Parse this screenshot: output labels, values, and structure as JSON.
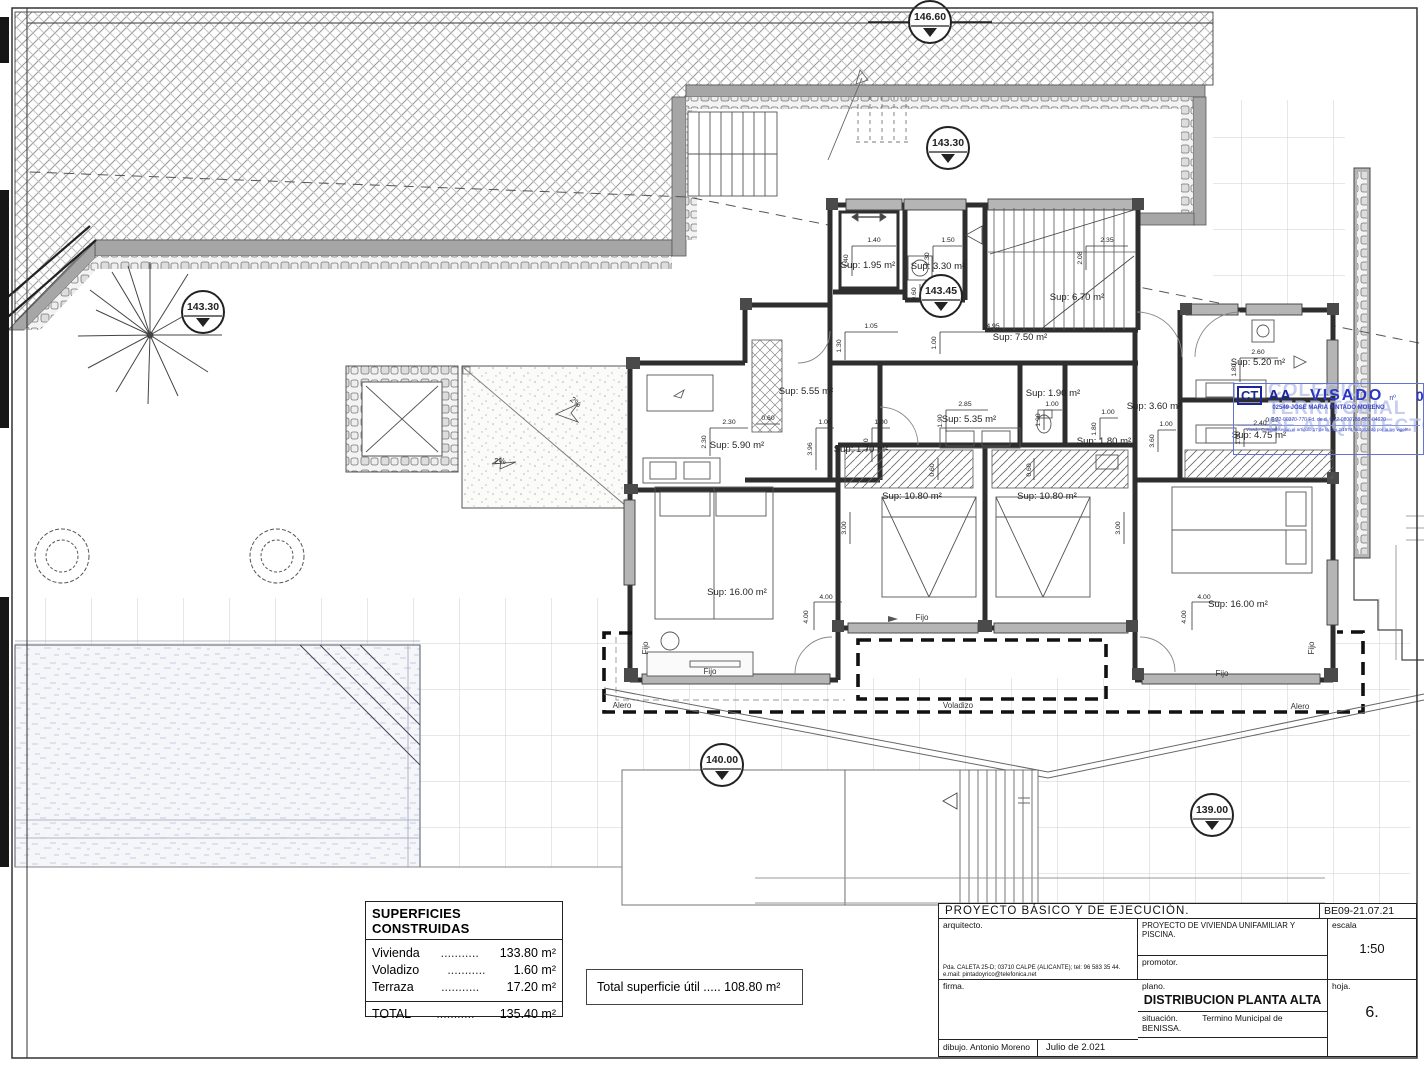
{
  "elevations": [
    "146.60",
    "143.30",
    "143.45",
    "143.30",
    "140.00",
    "139.00"
  ],
  "rooms": [
    "Sup: 1.95 m²",
    "Sup: 3.30 m²",
    "Sup: 6.70 m²",
    "Sup: 7.50 m²",
    "Sup: 5.55 m²",
    "Sup: 5.90 m²",
    "Sup: 1.70 m²",
    "Sup: 5.35 m²",
    "Sup: 1.90 m²",
    "Sup: 1.80 m²",
    "Sup: 3.60 m²",
    "Sup: 5.20 m²",
    "Sup: 4.75 m²",
    "Sup: 10.80 m²",
    "Sup: 10.80 m²",
    "Sup: 16.00 m²",
    "Sup: 16.00 m²"
  ],
  "dims": [
    "1.40",
    "1.40",
    "1.50",
    "2.30",
    "2.35",
    "2.08",
    "1.05",
    "1.30",
    "4.95",
    "1.00",
    "2.30",
    "2.30",
    "0.60",
    "1.00",
    "3.96",
    "1.00",
    "1.70",
    "2.85",
    "1.90",
    "1.00",
    "1.90",
    "1.00",
    "1.80",
    "2.60",
    "1.80",
    "1.00",
    "3.60",
    "2.40",
    "1.00",
    "0.60",
    "3.00",
    "3.00",
    "4.00",
    "4.00",
    "4.00",
    "4.00",
    "0.60",
    "0.60",
    "0.60"
  ],
  "annotations": {
    "fijo": "Fijo",
    "alero": "Alero",
    "voladizo": "Voladizo",
    "slope": "2%"
  },
  "stamp": {
    "logo_ct": "CT",
    "logo_aa": "AA",
    "watermark1": "COLEGIO",
    "watermark2": "TERRITORIAL",
    "watermark3": "DE ARQUITECTOS",
    "visado": "VISADO",
    "visado_sup": "nº",
    "date": "04/02/22",
    "collegiate": "02549 JOSE MARIA PINTADO MORENO",
    "code_line": "E:22-00370-770      Fd. de d.      0:22-0800788-801-04020",
    "legal_line": "Visado Colegial según el artículo 17 de la Ley 2/1974, autorizado por la ley vigente"
  },
  "areas_table": {
    "title": "SUPERFICIES CONSTRUIDAS",
    "rows": [
      {
        "label": "Vivienda",
        "dots": "...........",
        "value": "133.80 m²"
      },
      {
        "label": "Voladizo",
        "dots": "...........",
        "value": "1.60 m²"
      },
      {
        "label": "Terraza",
        "dots": "...........",
        "value": "17.20 m²"
      }
    ],
    "total": {
      "label": "TOTAL",
      "dots": "...........",
      "value": "135.40 m²"
    }
  },
  "useful_area": "Total superficie útil ..... 108.80 m²",
  "title_block": {
    "project_type": "PROYECTO  BÁSICO  Y  DE  EJECUCIÓN.",
    "ref": "BE09-21.07.21",
    "architect_label": "arquitecto.",
    "architect_addr1": "Pda. CALETA 25-D; 03710 CALPE (ALICANTE); tel: 96 583 35 44.",
    "architect_addr2": "e.mail: pintadoyrico@telefonica.net",
    "project_name": "PROYECTO  DE  VIVIENDA  UNIFAMILIAR  Y  PISCINA.",
    "promoter_label": "promotor.",
    "scale_label": "escala",
    "scale_value": "1:50",
    "signature_label": "firma.",
    "plan_label": "plano.",
    "plan_name": "DISTRIBUCION  PLANTA  ALTA",
    "location_label": "situación.",
    "location_value": "Termino Municipal de BENISSA.",
    "sheet_label": "hoja.",
    "sheet_number": "6.",
    "drawn_label": "dibujo.  Antonio Moreno",
    "date": "Julio de 2.021"
  }
}
